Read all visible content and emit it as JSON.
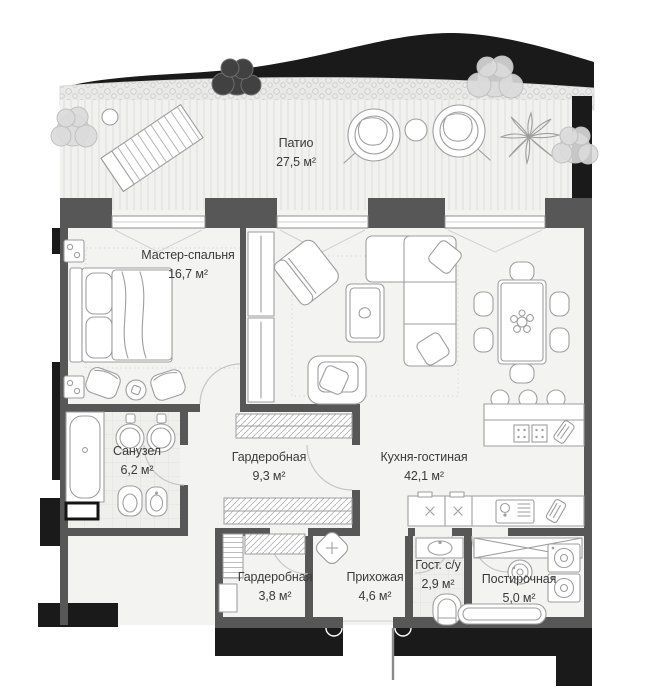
{
  "title": "Apartment floor plan with patio",
  "colors": {
    "wall": "#575757",
    "silhouette": "#1a1a1a",
    "floor": "#f3f3f2",
    "furniture_line": "#9e9e9e",
    "tree": "#dadada",
    "label_text": "#3a3a3a"
  },
  "rooms": [
    {
      "id": "patio",
      "name": "Патио",
      "area": "27,5 м²"
    },
    {
      "id": "master-bedroom",
      "name": "Мастер-спальня",
      "area": "16,7 м²"
    },
    {
      "id": "bathroom",
      "name": "Санузел",
      "area": "6,2 м²"
    },
    {
      "id": "wardrobe-large",
      "name": "Гардеробная",
      "area": "9,3 м²"
    },
    {
      "id": "kitchen-living",
      "name": "Кухня-гостиная",
      "area": "42,1 м²"
    },
    {
      "id": "wardrobe-small",
      "name": "Гардеробная",
      "area": "3,8 м²"
    },
    {
      "id": "hallway",
      "name": "Прихожая",
      "area": "4,6 м²"
    },
    {
      "id": "guest-wc",
      "name": "Гост. с/у",
      "area": "2,9 м²"
    },
    {
      "id": "laundry",
      "name": "Постирочная",
      "area": "5,0 м²"
    }
  ],
  "icons": [
    "tree-icon",
    "sun-lounger-icon",
    "hanging-chair-icon",
    "patio-table-icon",
    "palm-plant-icon",
    "bed-icon",
    "armchair-icon",
    "side-table-icon",
    "sconce-icon",
    "sofa-icon",
    "coffee-table-icon",
    "dining-table-icon",
    "dining-chair-icon",
    "kitchen-island-icon",
    "bar-stool-icon",
    "cooktop-icon",
    "cutting-board-icon",
    "kitchen-counter-icon",
    "sink-icon",
    "bathtub-icon",
    "washbasin-icon",
    "toilet-icon",
    "bidet-icon",
    "wardrobe-rail-icon",
    "pouf-icon",
    "vanity-icon",
    "floor-drain-icon",
    "washing-machine-icon",
    "laundry-basin-icon",
    "entrance-door-icon"
  ]
}
